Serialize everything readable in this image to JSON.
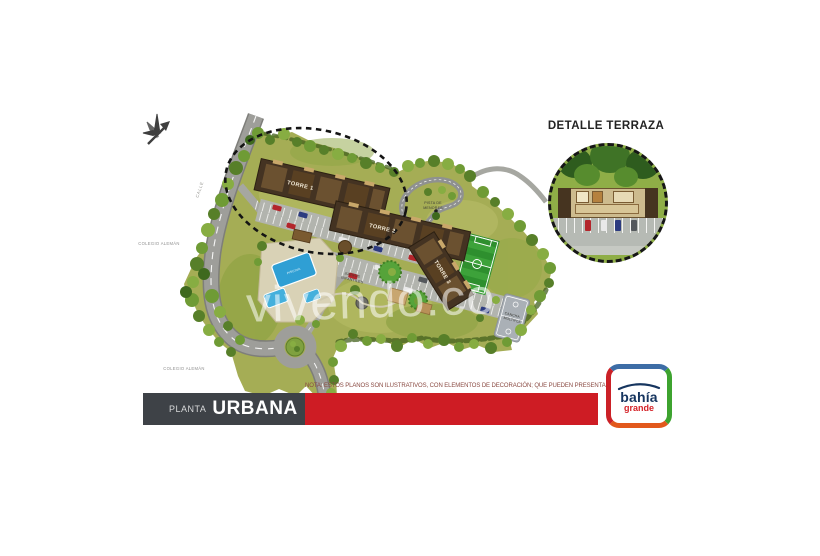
{
  "plan": {
    "watermark": "vivendo.co",
    "road_label": "CALLE",
    "context_label_upper": "COLEGIO ALEMÁN",
    "context_label_lower": "COLEGIO ALEMÁN",
    "towers": {
      "t1": "TORRE 1",
      "t2": "TORRE 2",
      "t3": "TORRE 3"
    },
    "amenities": {
      "track_line1": "PISTA DE",
      "track_line2": "MENORES",
      "playground_line1": "JUEGOS",
      "playground_line2": "INFANTILES",
      "court_line1": "CANCHA",
      "court_line2": "MÚLTIPLE",
      "pool": "PISCINA"
    }
  },
  "detail_inset": {
    "title": "DETALLE TERRAZA"
  },
  "footer": {
    "note": "NOTA: ESTOS PLANOS SON ILUSTRATIVOS, CON ELEMENTOS DE DECORACIÓN; QUE PUEDEN PRESENTAR VARIACIONES.",
    "plan_type": "PLANTA",
    "plan_name": "URBANA"
  },
  "logo": {
    "brand": "bahía",
    "brand_sub": "grande"
  },
  "colors": {
    "banner_red": "#ce1c24",
    "banner_dark": "#3e4247",
    "terrain_green": "#a5ad55",
    "road_gray": "#9e9e9a",
    "building_brown": "#443322",
    "pool_blue": "#2f9fd4",
    "field_green": "#2e8f2e",
    "logo_navy": "#16355f",
    "logo_red": "#d42127",
    "logo_green": "#3da32f",
    "logo_blue": "#3d6da6",
    "logo_orange": "#e2581c"
  }
}
